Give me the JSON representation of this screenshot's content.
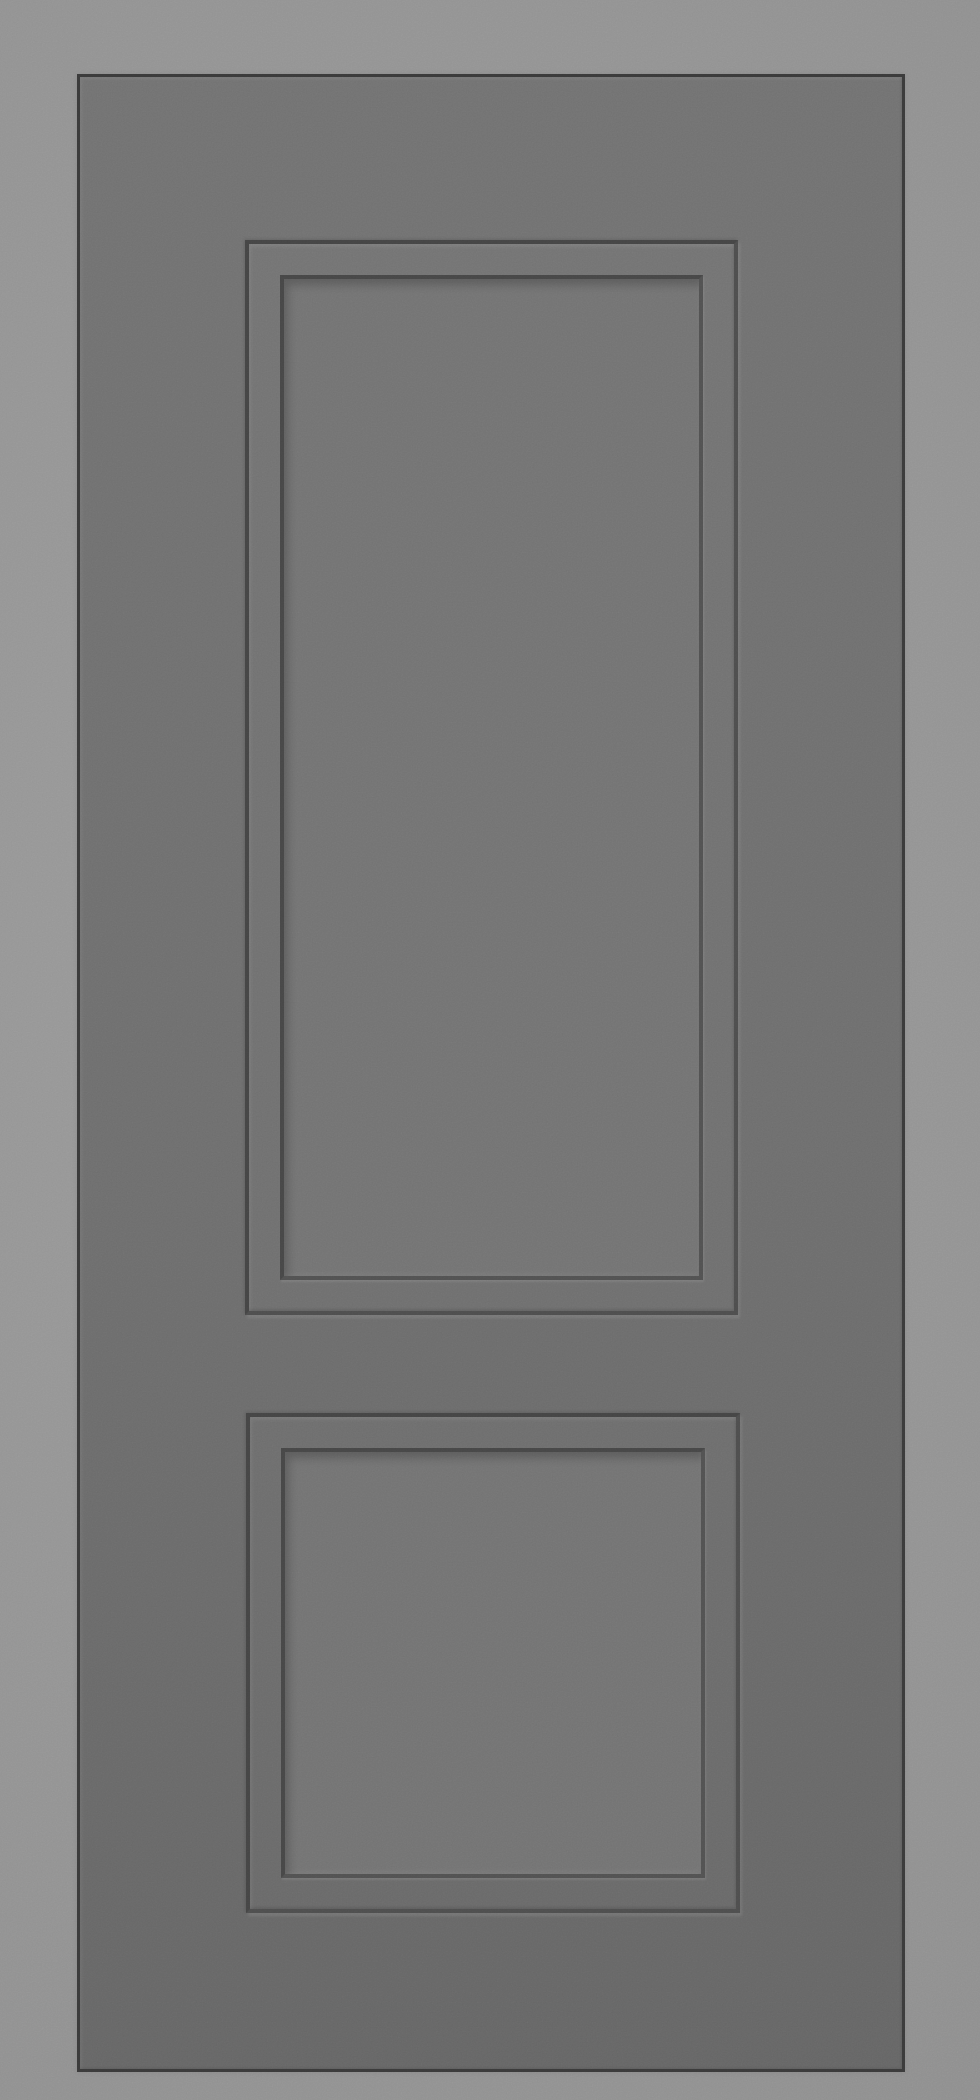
{
  "canvas": {
    "width": 980,
    "height": 2100
  },
  "colors": {
    "background_light": "#9a9a9a",
    "background": "#939393",
    "background_edge": "#8c8c8c",
    "door_face_top": "#727272",
    "door_face": "#6e6e6e",
    "door_face_bottom": "#666666",
    "door_outline": "#3a3a3a",
    "groove_dark_tl": "#454545",
    "groove_dark_br": "#4e4e4e",
    "groove_inner_tl": "#474747",
    "groove_inner_br": "#525252",
    "panel_field": "#737373"
  },
  "door": {
    "rect": {
      "x": 77,
      "y": 74,
      "width": 828,
      "height": 1998
    },
    "panels": [
      {
        "rect": {
          "x": 165,
          "y": 163,
          "width": 493,
          "height": 1075,
          "moulding_inset": 31
        }
      },
      {
        "rect": {
          "x": 166,
          "y": 1336,
          "width": 494,
          "height": 500,
          "moulding_inset": 31
        }
      }
    ]
  }
}
